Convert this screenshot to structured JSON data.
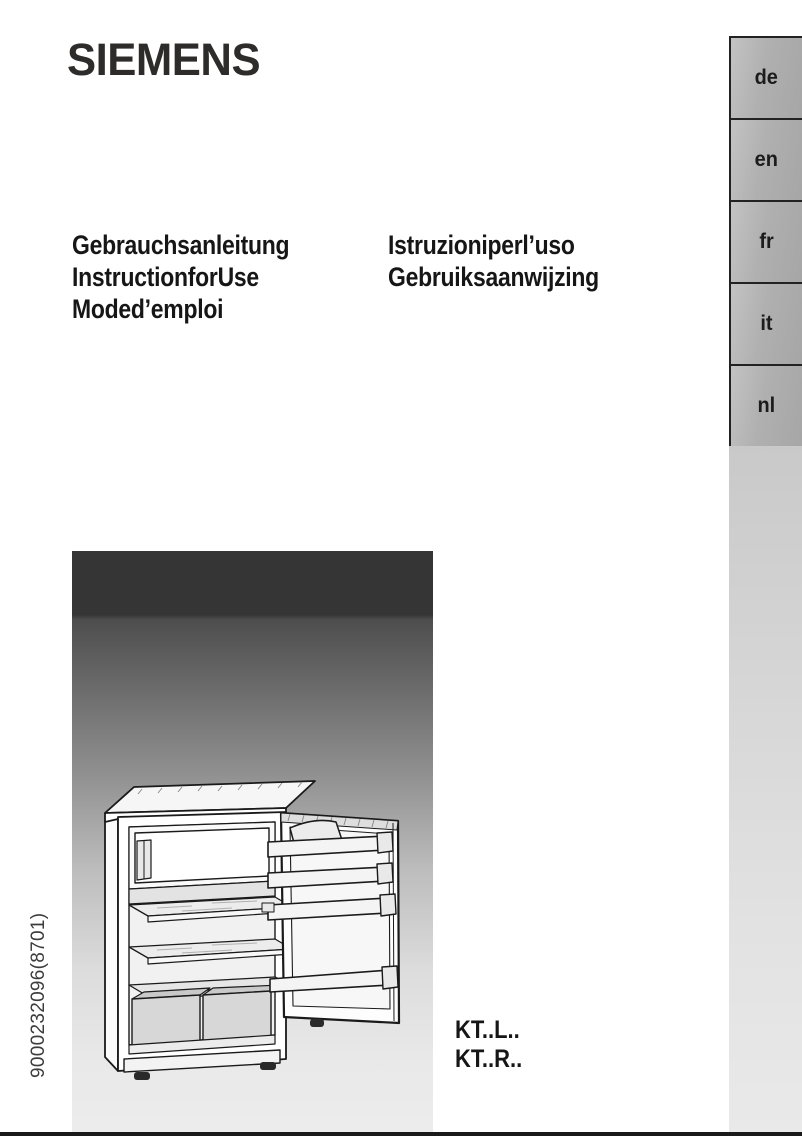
{
  "brand": "SIEMENS",
  "languages": [
    "de",
    "en",
    "fr",
    "it",
    "nl"
  ],
  "titles_left": [
    "Gebrauchsanleitung",
    "InstructionforUse",
    "Moded’emploi"
  ],
  "titles_right": [
    "Istruzioniperl’uso",
    "Gebruiksaanwijzing"
  ],
  "models": [
    "KT..L..",
    "KT..R.."
  ],
  "document_code": "9000232096(8701)",
  "illustration": "open-refrigerator-line-drawing",
  "colors": {
    "text": "#1a1a1a",
    "tab_fill": "#b0b0b0",
    "tab_border": "#222222",
    "column_fill": "#d6d6d6",
    "image_top": "#353535",
    "image_bottom": "#ececec",
    "bottom_bar": "#1a1a1a"
  }
}
